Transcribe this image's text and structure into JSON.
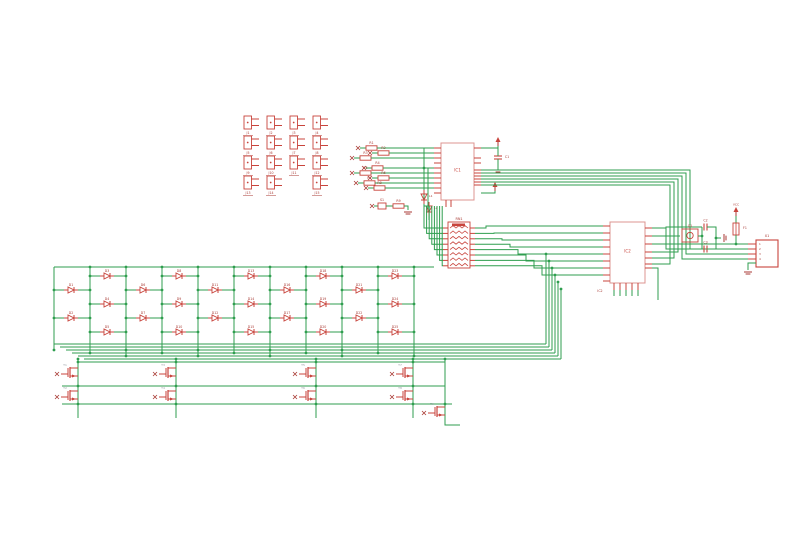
{
  "canvas": {
    "width": 800,
    "height": 540,
    "background": "#ffffff"
  },
  "colors": {
    "net": "#2f9e4f",
    "part": "#c8443c",
    "part_light": "#dc9490",
    "part_dark": "#a83a34",
    "label_gray": "#9aa0a6",
    "junction": "#2f9e4f"
  },
  "jack_grid": {
    "cols_x": [
      244,
      267,
      290,
      313
    ],
    "rows_y": [
      116,
      136,
      156,
      176
    ],
    "skip": [
      [
        3,
        2
      ]
    ],
    "labels": [
      "J1",
      "J2",
      "J3",
      "J4",
      "J5",
      "J6",
      "J7",
      "J8",
      "J9",
      "J10",
      "J11",
      "J12",
      "J13",
      "J14",
      "J15"
    ]
  },
  "ic1": {
    "x": 441,
    "y": 143,
    "w": 33,
    "h": 57,
    "label": "IC1",
    "pins_left_y": [
      148,
      153,
      158,
      163,
      168,
      173,
      178,
      183,
      188,
      193
    ],
    "pins_right_y": [
      148,
      158,
      163,
      170,
      173,
      176,
      179,
      182,
      185
    ],
    "pins_bottom_x": [
      446,
      451
    ]
  },
  "input_rows": [
    {
      "y": 148,
      "flag_x": 358,
      "part_x": 366,
      "label": "R1"
    },
    {
      "y": 153,
      "flag_x": 370,
      "part_x": 378,
      "label": "R2"
    },
    {
      "y": 158,
      "flag_x": 352,
      "part_x": 360,
      "label": "R3"
    },
    {
      "y": 168,
      "flag_x": 364,
      "part_x": 372,
      "label": "R4"
    },
    {
      "y": 173,
      "flag_x": 352,
      "part_x": 360,
      "label": "R5"
    },
    {
      "y": 178,
      "flag_x": 370,
      "part_x": 378,
      "label": "R6"
    },
    {
      "y": 183,
      "flag_x": 356,
      "part_x": 364,
      "label": "R7"
    },
    {
      "y": 188,
      "flag_x": 366,
      "part_x": 374,
      "label": "R8"
    }
  ],
  "ic1_decouple": {
    "vcc_x": 498,
    "vcc_y": 140,
    "cap_x": 498,
    "cap_y": 156,
    "cap_label": "C1",
    "gnd_y": 170,
    "arrow2_x": 495,
    "arrow2_y": 185
  },
  "sub_circuit": {
    "flag_x": 372,
    "y": 206,
    "switch_x": 378,
    "switch_label": "S1",
    "res_x": 393,
    "res_label": "R9",
    "gnd_x": 408,
    "led1": [
      424,
      197
    ],
    "led2": [
      429,
      209
    ],
    "led_labels": [
      "L1",
      "L2"
    ]
  },
  "rn": {
    "x": 448,
    "y": 222,
    "w": 22,
    "h": 46,
    "label": "RN1",
    "pins": 8,
    "pin_y0": 228,
    "pin_dy": 5.4
  },
  "ic2": {
    "x": 610,
    "y": 222,
    "w": 35,
    "h": 61,
    "label": "IC2",
    "pins_left_y": [
      226,
      233,
      240,
      247,
      254,
      261,
      268,
      275,
      281
    ],
    "pins_right_y": [
      228,
      236,
      244,
      252,
      258,
      264,
      268
    ],
    "pins_bottom_x": [
      614,
      620,
      626,
      632,
      638
    ]
  },
  "right_bundle": {
    "rows_y": [
      170,
      173,
      176,
      179,
      182,
      185
    ],
    "vx": [
      690,
      686,
      682,
      678,
      674,
      670
    ],
    "drop_y": [
      249,
      254,
      259,
      252,
      258,
      264
    ],
    "dest": [
      "usb",
      "usb",
      "usb",
      "ic2",
      "ic2",
      "ic2"
    ]
  },
  "usb": {
    "x": 756,
    "y": 240,
    "w": 22,
    "h": 27,
    "label": "X1",
    "pin_ys": [
      244,
      249,
      254,
      259
    ],
    "pin_labels": [
      "1",
      "2",
      "3",
      "4"
    ],
    "gnd_x": 748,
    "gnd_y": 270
  },
  "crystal": {
    "x": 682,
    "y": 229,
    "w": 16,
    "h": 13,
    "label": "Q1"
  },
  "xtal_caps": {
    "x": 702,
    "top_y": 227,
    "bot_y": 249,
    "labels": [
      "C2",
      "C3"
    ],
    "gnd_x": 723,
    "gnd_y": 238
  },
  "fuse": {
    "x": 736,
    "y": 223,
    "label": "F1",
    "vcc_label": "VCC"
  },
  "matrix": {
    "rail_y": 267,
    "group_x": [
      62,
      134,
      206,
      278,
      350
    ],
    "cell_offsets": [
      [
        2,
        290
      ],
      [
        2,
        318
      ],
      [
        38,
        276
      ],
      [
        38,
        304
      ],
      [
        38,
        332
      ]
    ],
    "cell_labels": [
      "D1",
      "D2",
      "D3",
      "D4",
      "D5",
      "D6",
      "D7",
      "D8",
      "D9",
      "D10",
      "D11",
      "D12",
      "D13",
      "D14",
      "D15",
      "D16",
      "D17",
      "D18",
      "D19",
      "D20",
      "D21",
      "D22",
      "D23",
      "D24",
      "D25"
    ],
    "bundle_left_x": [
      54,
      60,
      66,
      72,
      78,
      84
    ],
    "bundle_ys": [
      344,
      347,
      350,
      353,
      356,
      359
    ],
    "bundle_right_x": [
      546,
      549,
      552,
      555,
      558,
      561
    ]
  },
  "mosfets": {
    "cols": [
      70,
      168,
      308,
      405
    ],
    "rows": [
      372,
      395
    ],
    "extra": [
      437,
      411
    ],
    "labels": [
      "T1",
      "T2",
      "T3",
      "T4",
      "T5",
      "T6",
      "T7",
      "T8",
      "T9"
    ],
    "rails": {
      "top_y": 362,
      "mid_y": 386,
      "bot_y": 404
    }
  }
}
